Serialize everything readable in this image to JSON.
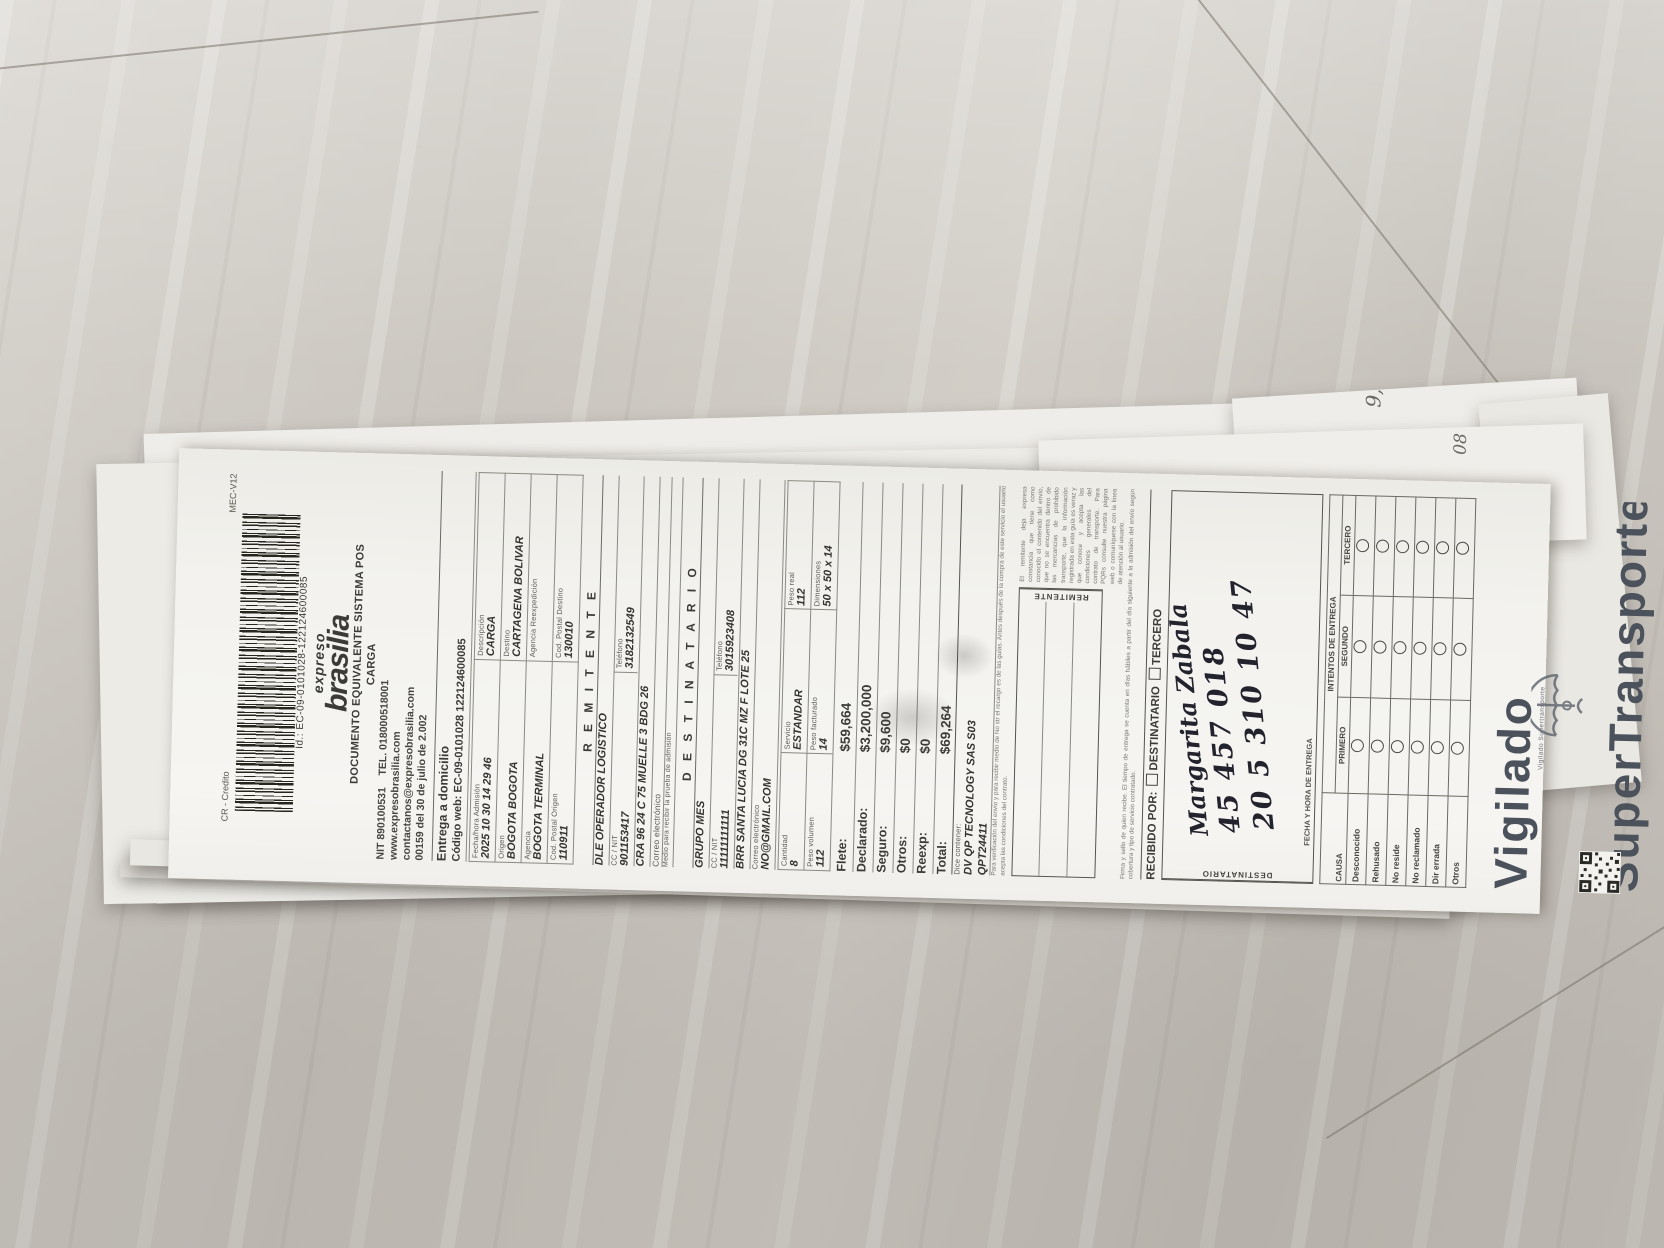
{
  "colors": {
    "paper": "#f3f2ee",
    "ink": "#3c3b38",
    "vigilado": "#4b525b",
    "wood": "#cdc9c2"
  },
  "header": {
    "credit_label": "CR - Credito",
    "mec_label": "MEC-V12",
    "barcode_id": "Id.: EC-09-0101028-122124600085",
    "brand_top": "expreso",
    "brand": "brasilia",
    "doc_line1": "DOCUMENTO EQUIVALENTE SISTEMA POS",
    "doc_line2": "CARGA",
    "nit": "NIT 890100531",
    "tel": "TEL. 018000518001",
    "web": "www.expresobrasilia.com",
    "email": "contactanos@expresobrasilia.com",
    "resolution": "00159 del 30 de julio de 2.002"
  },
  "service": {
    "title": "Entrega a domicilio",
    "code_label": "Código web:",
    "code_value": "EC-09-0101028 122124600085"
  },
  "info": {
    "rows": [
      {
        "l": {
          "label": "Fecha/hora Admisión",
          "value": "2025 10 30 14 29 46"
        },
        "r": {
          "label": "Descripción",
          "value": "CARGA"
        }
      },
      {
        "l": {
          "label": "Origen",
          "value": "BOGOTA BOGOTA"
        },
        "r": {
          "label": "Destino",
          "value": "CARTAGENA BOLIVAR"
        }
      },
      {
        "l": {
          "label": "Agencia",
          "value": "BOGOTA TERMINAL"
        },
        "r": {
          "label": "Agencia Reexpedición",
          "value": ""
        }
      },
      {
        "l": {
          "label": "Cod. Postal Origen",
          "value": "110911"
        },
        "r": {
          "label": "Cod. Postal Destino",
          "value": "130010"
        }
      }
    ]
  },
  "remitente": {
    "title": "R E M I T E N T E",
    "name": "DLE OPERADOR LOGISTICO",
    "cc_label": "CC / NIT",
    "cc": "901153417",
    "tel_label": "Teléfono",
    "tel": "3182132549",
    "address": "CRA 96 24 C 75 MUELLE 3 BDG 26",
    "email_label": "Correo electrónico",
    "email": "",
    "proof_label": "Medio para recibir la prueba de admisión"
  },
  "destinatario": {
    "title": "D E S T I N A T A R I O",
    "name": "GRUPO MES",
    "cc_label": "CC / NIT",
    "cc": "11111111111",
    "tel_label": "Teléfono",
    "tel": "3015923408",
    "address": "BRR SANTA LUCIA DG 31C MZ F LOTE 25",
    "email_label": "Correo electrónico",
    "email": "NO@GMAIL.COM"
  },
  "shipment": {
    "cantidad_label": "Cantidad",
    "cantidad": "8",
    "servicio_label": "Servicio",
    "servicio": "ESTANDAR",
    "peso_real_label": "Peso real",
    "peso_real": "112",
    "peso_vol_label": "Peso volumen",
    "peso_vol": "112",
    "peso_fact_label": "Peso facturado",
    "peso_fact": "14",
    "dim_label": "Dimensiones",
    "dim": "50 x 50 x 14"
  },
  "charges": {
    "rows": [
      {
        "label": "Flete:",
        "value": "$59,664"
      },
      {
        "label": "Declarado:",
        "value": "$3,200,000"
      },
      {
        "label": "Seguro:",
        "value": "$9,600"
      },
      {
        "label": "Otros:",
        "value": "$0"
      },
      {
        "label": "Reexp:",
        "value": "$0"
      },
      {
        "label": "Total:",
        "value": "$69,264"
      }
    ]
  },
  "contents": {
    "label": "Dice contener:",
    "line1": "DV QP TECNOLOGY SAS S03",
    "line2": "QPT24411"
  },
  "fine_print_1": "Para verificación del envío y para recibir medio de No str el recargo es de las guías. Antes después de la compra de este servicio el usuario acepta las condiciones del contrato.",
  "fine_print_2": "El remitente deja expresa constancia que tiene como conocido el contenido del envío, que no se encuentra dentro de las mercancías de prohibido transporte, que la información registrada en esta guía es veraz y que conoce y acepta las condiciones generales del contrato de transporte. Para PQRs consulte nuestra página web o comuníquese con la línea de atención al usuario.",
  "fine_print_3": "Firma y sello de quien recibe. El tiempo de entrega se cuenta en días hábiles a partir del día siguiente a la admisión del envío según cobertura y tipo de servicio contratado.",
  "boxes": {
    "remitente_label": "REMITENTE",
    "destinatario_label": "DESTINATARIO"
  },
  "recibido": {
    "label": "RECIBIDO POR:",
    "opt1": "DESTINATARIO",
    "opt2": "TERCERO",
    "hand_name": "Margarita Zabala",
    "hand_id": "45 457 018",
    "hand_date": "20 5 310 10 47",
    "fecha_label": "FECHA Y HORA DE ENTREGA"
  },
  "attempts": {
    "title": "INTENTOS DE ENTREGA",
    "causa_label": "CAUSA",
    "cols": [
      "PRIMERO",
      "SEGUNDO",
      "TERCERO"
    ],
    "causes": [
      "Desconocido",
      "Rehusado",
      "No reside",
      "No reclamado",
      "Dir errada",
      "Otros"
    ]
  },
  "footer": {
    "system_line": "lo y expedido por sistema FivePostal Nit. 900067542",
    "big1": "Vigilado",
    "big2": "SuperTransporte",
    "small": "Vigilado Supertransporte"
  },
  "stack_marks": {
    "m1": "9,",
    "m2": "08"
  }
}
